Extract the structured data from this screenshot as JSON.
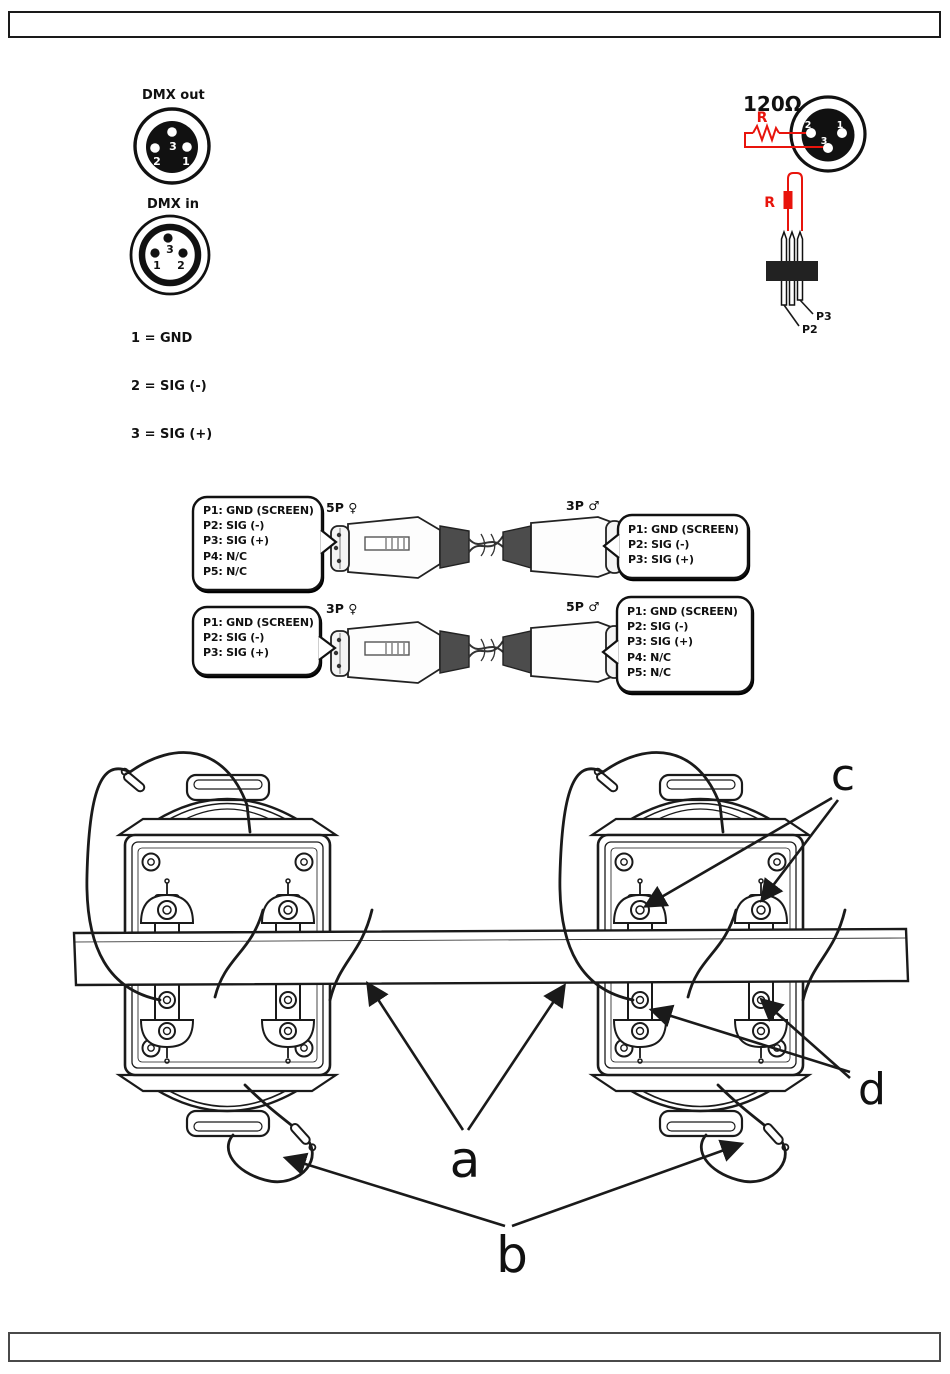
{
  "page": {
    "type": "manual-diagram-page"
  },
  "dmx_pinout": {
    "out_label": "DMX out",
    "in_label": "DMX in",
    "pins": {
      "p1": "1",
      "p2": "2",
      "p3": "3"
    },
    "legend": [
      "1 = GND",
      "2 = SIG (-)",
      "3 = SIG (+)"
    ]
  },
  "terminator": {
    "value_label": "120Ω",
    "r_label_top": "R",
    "r_label_bottom": "R",
    "pins": {
      "p1": "1",
      "p2": "2",
      "p3": "3"
    },
    "header_pins": {
      "p2": "P2",
      "p3": "P3"
    }
  },
  "adapters": {
    "cable_5f_3m": {
      "left_label": "5P ♀",
      "right_label": "3P ♂",
      "left_pins": [
        "P1: GND (SCREEN)",
        "P2: SIG (-)",
        "P3: SIG (+)",
        "P4: N/C",
        "P5: N/C"
      ],
      "right_pins": [
        "P1: GND (SCREEN)",
        "P2: SIG (-)",
        "P3: SIG (+)"
      ]
    },
    "cable_3f_5m": {
      "left_label": "3P ♀",
      "right_label": "5P ♂",
      "left_pins": [
        "P1: GND (SCREEN)",
        "P2: SIG (-)",
        "P3: SIG (+)"
      ],
      "right_pins": [
        "P1: GND (SCREEN)",
        "P2: SIG (-)",
        "P3: SIG (+)",
        "P4: N/C",
        "P5: N/C"
      ]
    }
  },
  "mounting": {
    "labels": {
      "a": "a",
      "b": "b",
      "c": "c",
      "d": "d"
    }
  },
  "colors": {
    "accent_red": "#e8140c",
    "line_black": "#1a1a1a",
    "boot_gray": "#4c4c4c"
  }
}
